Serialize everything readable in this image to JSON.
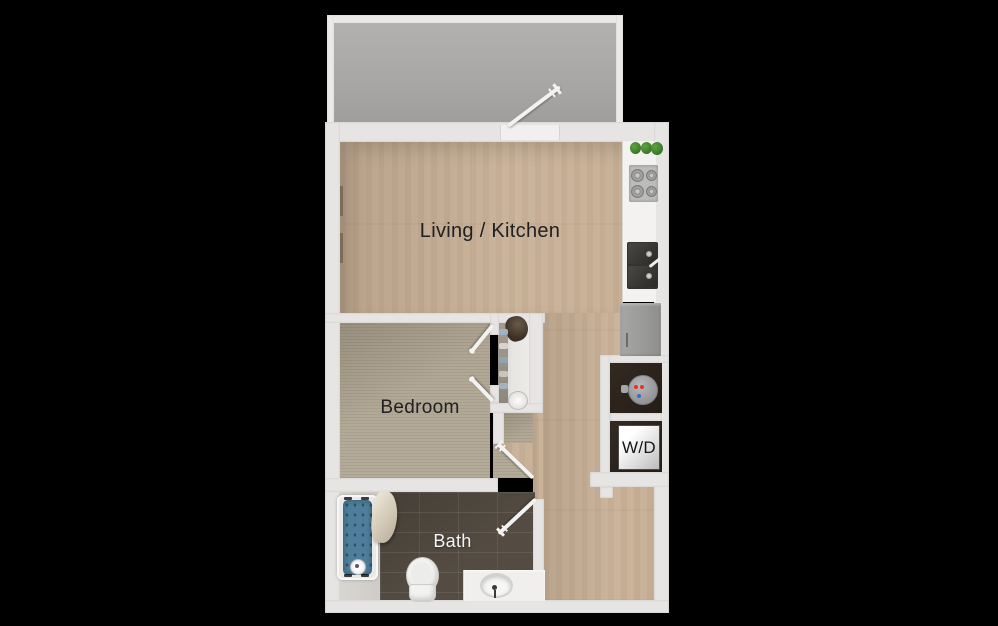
{
  "rooms": {
    "living": {
      "label": "Living / Kitchen"
    },
    "bedroom": {
      "label": "Bedroom"
    },
    "bath": {
      "label": "Bath"
    },
    "laundry": {
      "label": "W/D"
    }
  },
  "colors": {
    "bg": "#000000",
    "wall": "#e7e5e3",
    "balcony_floor": "#a8a6a4",
    "wood": "#c8b096",
    "carpet": "#b0a693",
    "tile": "#544c42",
    "counter": "#f3f2f1",
    "appliance": "#9d9d9b",
    "sink_dark": "#35332f",
    "tub_water": "#4e7e99",
    "plant": "#3f7d2c",
    "heater_red": "#e23429",
    "heater_blue": "#2f6ed6",
    "label_dark": "#202020",
    "label_light": "#f5f5f5"
  }
}
